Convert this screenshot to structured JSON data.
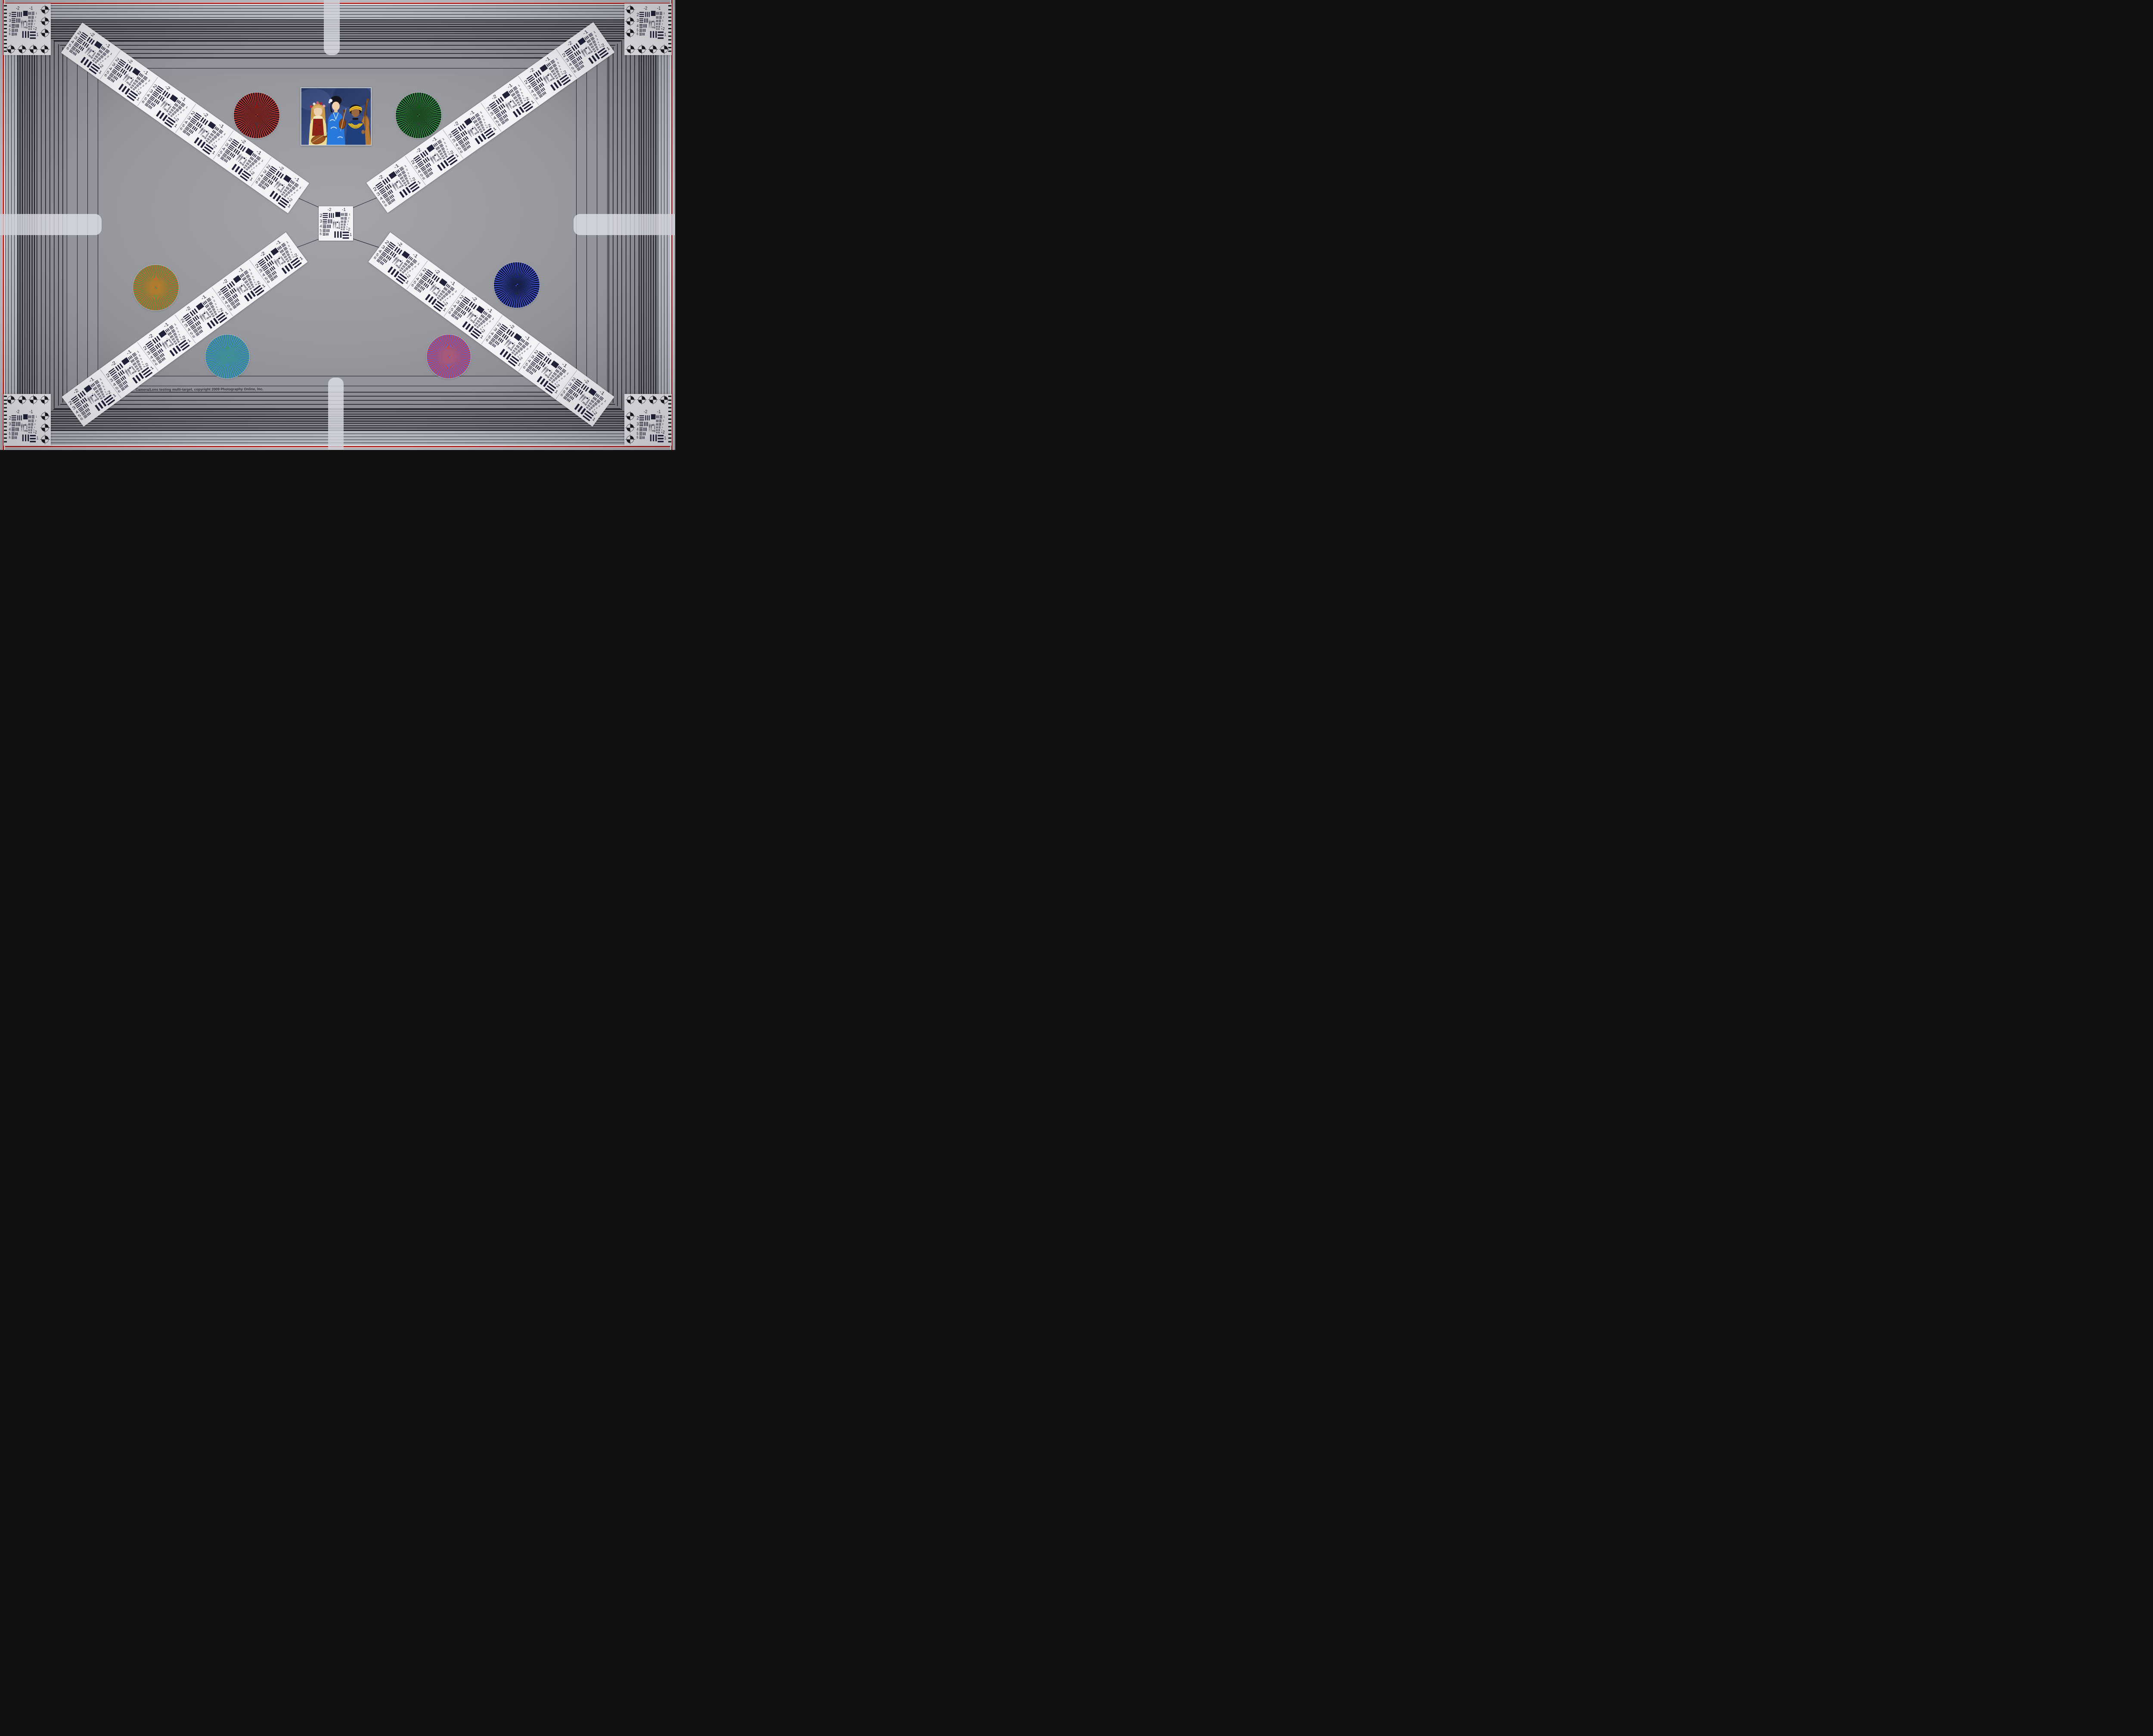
{
  "copyright_line": "Camera/Lens testing multi-target, copyright 2009 Photography Online, Inc.",
  "usaf_labels": {
    "top_left": "-2",
    "top_right": "-1",
    "left_rows": [
      "2",
      "3",
      "4",
      "5",
      "6"
    ],
    "right_rows": [
      "1",
      "2",
      "3",
      "4",
      "5",
      "6"
    ],
    "mini_left": "0",
    "mini_right": "1",
    "bottom_right_upper": "-2",
    "bottom_right_lower": "1"
  },
  "wheels": [
    {
      "name": "red-black-starburst",
      "colors": [
        "#c5372b",
        "#17121f"
      ],
      "blend": "#6e2320"
    },
    {
      "name": "green-black-starburst",
      "colors": [
        "#2f8f3a",
        "#10151a"
      ],
      "blend": "#1d4a22"
    },
    {
      "name": "red-green-starburst",
      "colors": [
        "#d2502e",
        "#46a04c"
      ],
      "blend": "#b07c2e"
    },
    {
      "name": "blue-black-starburst",
      "colors": [
        "#3a50cc",
        "#0c0c20"
      ],
      "blend": "#16204a"
    },
    {
      "name": "green-blue-starburst",
      "colors": [
        "#3fae6e",
        "#4166d4"
      ],
      "blend": "#3e8f96"
    },
    {
      "name": "red-blue-starburst",
      "colors": [
        "#d24434",
        "#5560dc"
      ],
      "blend": "#a85a78"
    }
  ],
  "frame": {
    "red_border_color": "#b8241f",
    "stripe_line_color": "#17171f",
    "field_gray": "#97989e",
    "target_white": "#f2f2f5"
  }
}
